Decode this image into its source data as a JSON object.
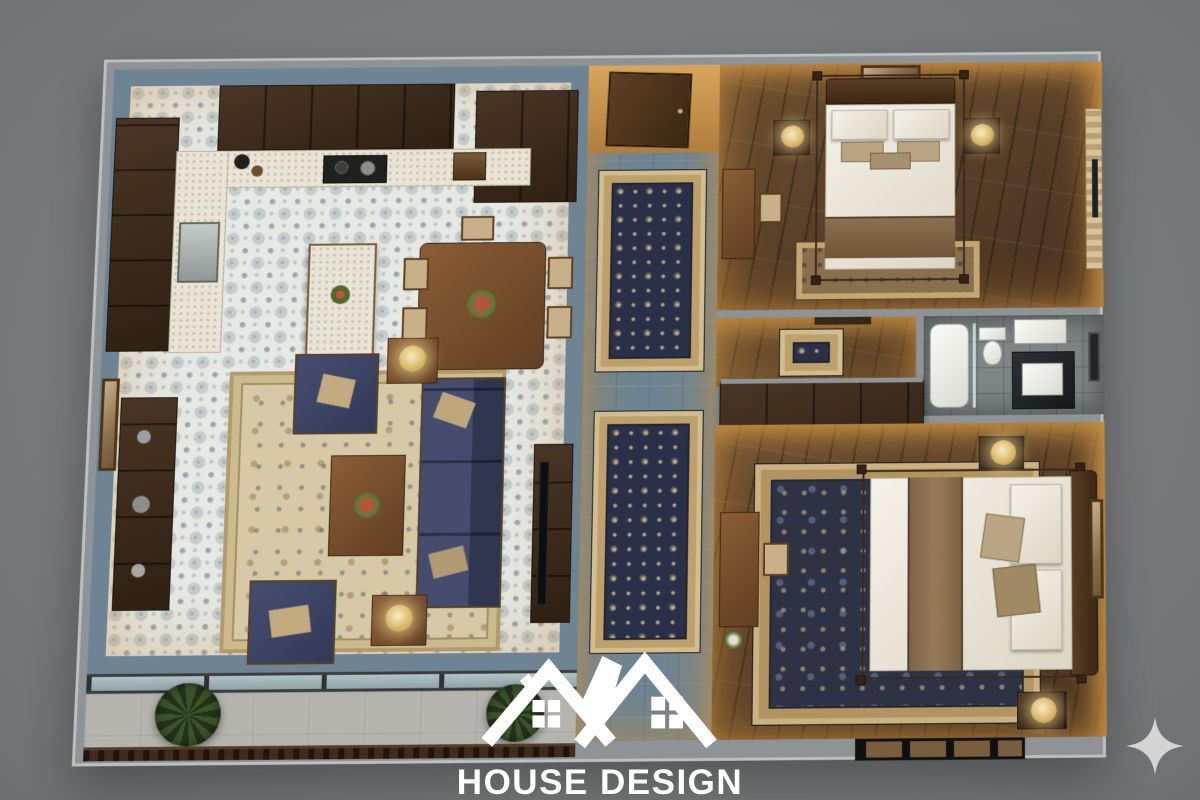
{
  "branding": {
    "title": "HOUSE DESIGN",
    "tagline": "construction & interior",
    "logo_icon": "twin-house-roofs-icon"
  },
  "decorations": {
    "sparkle_icon": "four-point-star"
  },
  "palette": {
    "background": "#797b7d",
    "wall_top": "#8d9397",
    "wall_face_amber": "#c9964f",
    "tile_blue": "#6e8494",
    "tile_pattern_base": "#e6e8e3",
    "wood_dark": "#3a2a1d",
    "wood_floor": "#5a4128",
    "sofa_navy": "#3c4260",
    "rug_cream": "#d7c9a8",
    "runner_navy": "#2a3047",
    "bathroom_gray": "#7e8585",
    "logo_white": "#ffffff",
    "sparkle_gray": "#d4d4d4"
  },
  "scene": {
    "view": "3d-top-down-apartment-floor-plan",
    "rooms": [
      {
        "name": "kitchen-dining",
        "furnishings": [
          "l-shaped-dark-wood-cabinets",
          "white-counter-with-cooktop",
          "sink",
          "kitchen-island",
          "dining-table-with-six-chairs",
          "tall-cupboard",
          "patterned-blue-white-tile-floor"
        ]
      },
      {
        "name": "living-room",
        "furnishings": [
          "navy-three-seat-sofa",
          "two-navy-armchairs",
          "wood-coffee-table",
          "two-side-tables-with-lamps",
          "sideboard-with-decor",
          "wall-art",
          "tv-console",
          "cream-area-rug"
        ]
      },
      {
        "name": "hallway",
        "furnishings": [
          "entry-door",
          "two-ornate-runner-rugs",
          "blue-tile-floor"
        ]
      },
      {
        "name": "bedroom-1",
        "furnishings": [
          "four-poster-bed",
          "two-nightstands-with-lamps",
          "wall-art-above-bed",
          "desk-and-chair",
          "curtained-window",
          "foot-rug",
          "wood-floor"
        ]
      },
      {
        "name": "bathroom",
        "furnishings": [
          "bathtub",
          "toilet",
          "vanity-with-basin",
          "shower-tray",
          "window",
          "gray-tile-floor"
        ]
      },
      {
        "name": "vestibule",
        "furnishings": [
          "small-rug",
          "door"
        ]
      },
      {
        "name": "bedroom-2",
        "furnishings": [
          "four-poster-bed",
          "built-in-wardrobe",
          "two-nightstands-with-lamps",
          "desk-and-chair",
          "large-navy-cream-rug",
          "wall-art",
          "bottom-window-band"
        ]
      },
      {
        "name": "balcony",
        "furnishings": [
          "glass-wall",
          "two-potted-plants",
          "wood-railing",
          "concrete-floor"
        ]
      }
    ]
  }
}
